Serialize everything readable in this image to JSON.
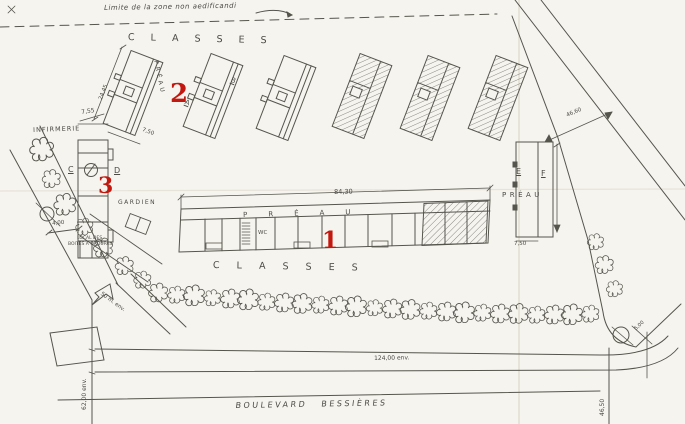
{
  "palette": {
    "paper": "#f6f4ee",
    "ink": "#4b4a44",
    "marker_red": "#c2180f"
  },
  "markers": {
    "m1": "1",
    "m2": "2",
    "m3": "3"
  },
  "labels": {
    "limit_note": "Limite de la zone non aedificandi",
    "classes_top": "CLASSES",
    "classes_bottom": "CLASSES",
    "preau_b1": "PRÉAU",
    "preau_center": "PRÉAU",
    "preau_ef": "PRÉAU",
    "wc": "WC",
    "infirmerie": "INFIRMERIE",
    "gardien": "GARDIEN",
    "local_line1": "LOCAL DES",
    "local_line2": "BOITES A ORDURES",
    "boulevard": "BOULEVARD BESSIÈRES",
    "bldg_a": "A",
    "bldg_b": "B",
    "bldg_c": "C",
    "bldg_d": "D",
    "bldg_e": "E",
    "bldg_f": "F"
  },
  "dimensions": {
    "d_755": "7,55",
    "d_2445": "24,45",
    "d_750_b1": "7,50",
    "d_400": "4,00",
    "d_8430": "84,30",
    "d_750_ef": "7,50",
    "d_4660": "46,60",
    "d_124": "124,00 env.",
    "d_62": "62,00 env.",
    "d_50m": "50 m. env.",
    "d_4650": "46,50",
    "d_500": "5,00"
  }
}
